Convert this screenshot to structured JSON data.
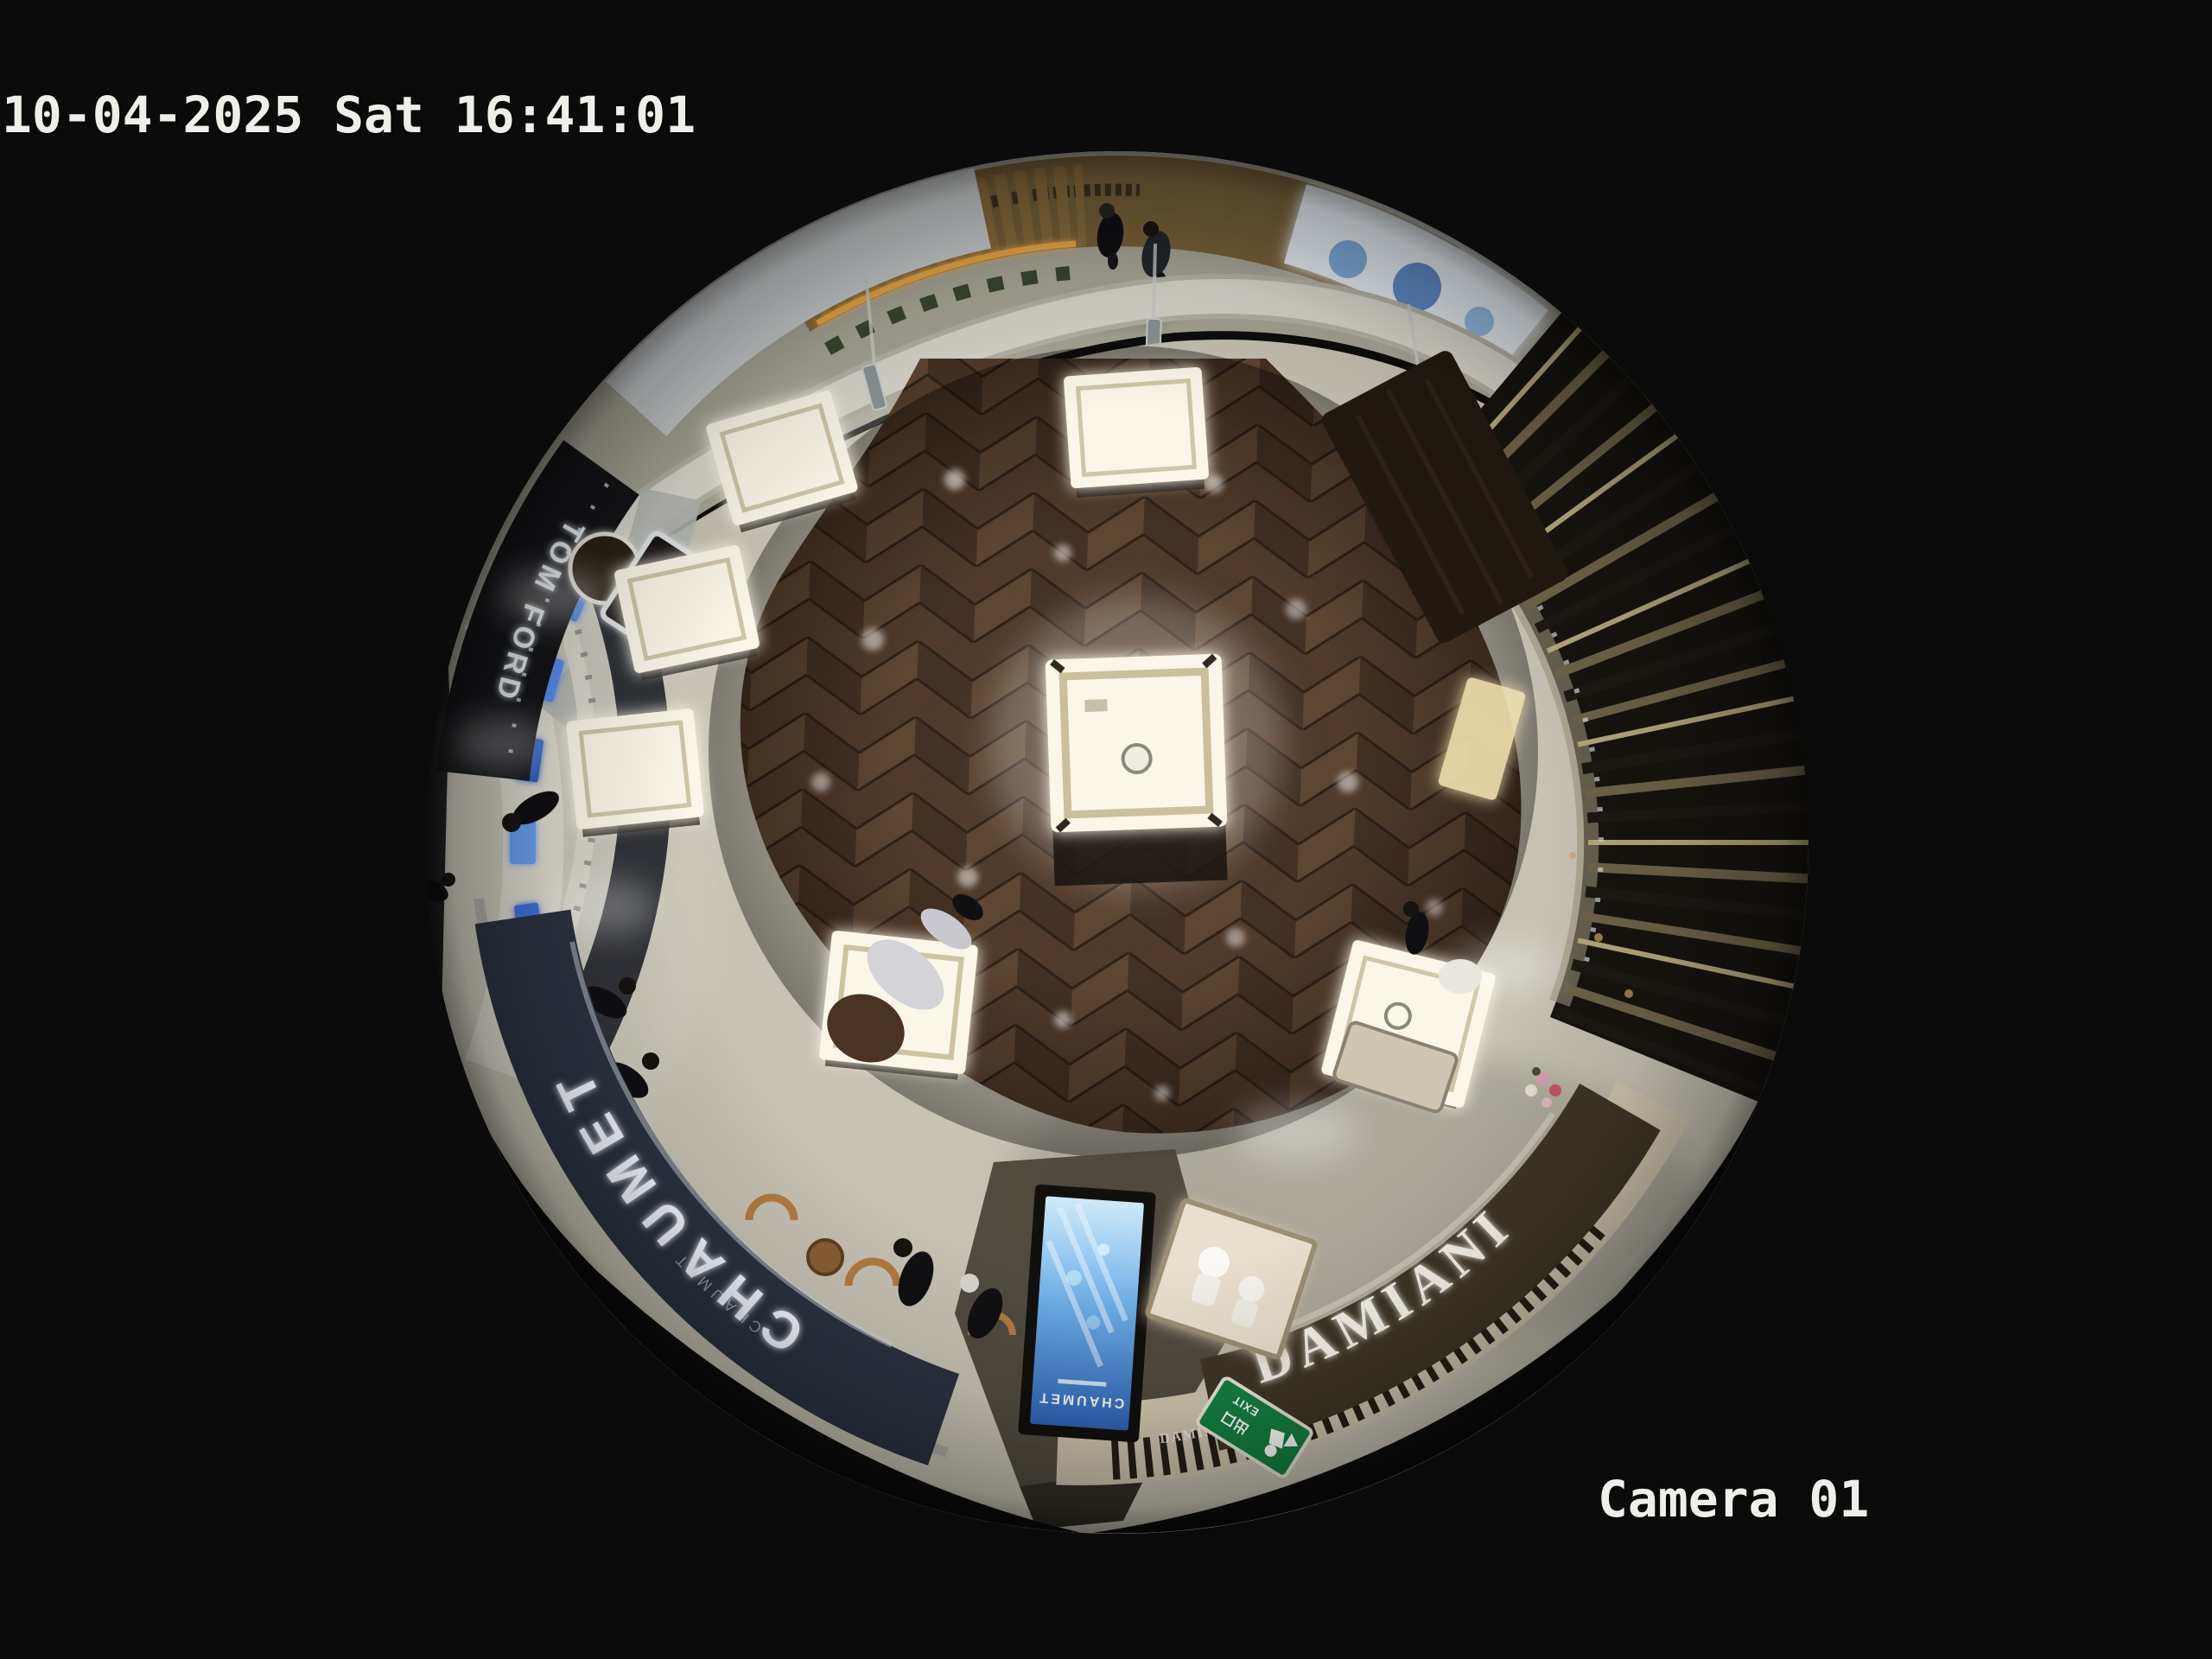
{
  "osd": {
    "timestamp": "10-04-2025 Sat 16:41:01",
    "camera_label": "Camera 01"
  },
  "scene": {
    "description": "fisheye-overhead-view-luxury-jewelry-boutique-and-mall-corridor",
    "signs": {
      "chaumet_main": "CHAUMET",
      "chaumet_sub": "CHAUMET",
      "chaumet_screen": "CHAUMET",
      "damiani_main": "DAMIANI",
      "damiani_small": "DAMIANI",
      "tom_ford": "TOM FORD",
      "tf_monogram": "TF",
      "exit_cn": "出口",
      "exit_en": "EXIT"
    },
    "colors": {
      "bg": "#0b0b0c",
      "osd_text": "#efefe9",
      "marble": "#a8a597",
      "tile": "#c7c2b4",
      "tile_bright": "#e0ddd2",
      "threshold": "#d9d6cc",
      "wood_base": "#523b2a",
      "wood_mid": "#6a4e36",
      "wood_dark": "#3a2a1e",
      "gold_wall": "#78623a",
      "planter_wood": "#8a6c3e",
      "led_amber": "#edaa46",
      "window_glow": "#e9f0f6",
      "window_blue": "#4a7abf",
      "bulkhead_white": "#d8d8d2",
      "chaumet_fascia": "#2b3340",
      "chaumet_letter": "#f4f8ff",
      "damiani_fascia": "#3e3526",
      "damiani_beige": "#cfc5ad",
      "damiani_letter": "#f7f4ec",
      "slat_dark": "#1c1914",
      "slat_mid": "#6e6448",
      "slat_light": "#b5a87c",
      "interior_dark": "#17140f",
      "vitrine_glow": "#faf6e8",
      "vitrine_frame": "#c3ba94",
      "screen_blue": "#3f74c8",
      "exit_green": "#15803f",
      "person_dark": "#101013",
      "hair_brown": "#4a3322",
      "chair_wood": "#b27c42",
      "counter_dark": "#4c463c"
    }
  }
}
